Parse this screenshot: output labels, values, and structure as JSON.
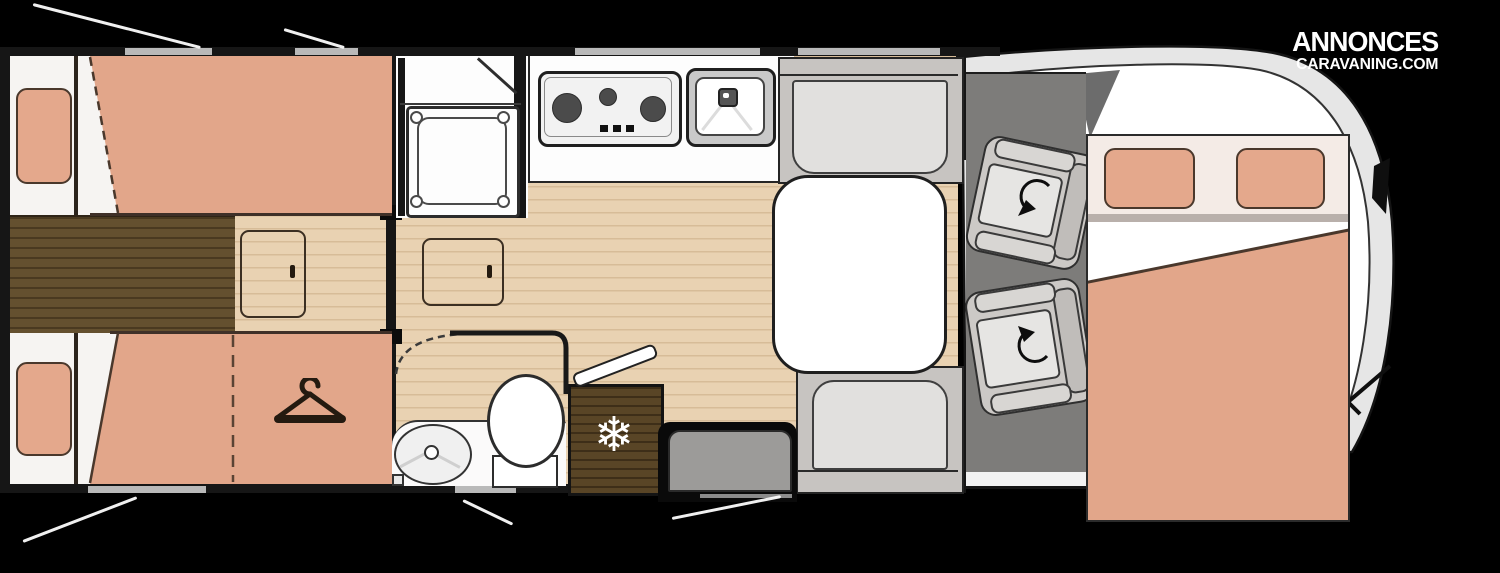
{
  "brand": {
    "line1": "ANNONCES",
    "line2": "CARAVANING.COM"
  },
  "icons": {
    "snowflake": "❄"
  },
  "palette": {
    "background": "#000000",
    "upholstery_salmon": "#e2a68a",
    "bed_linen_white": "#ffffff",
    "drop_bed_header": "#f4ebe6",
    "wood_floor_light": "#e9d2b2",
    "wood_dark": "#64502f",
    "fridge_wood": "#594526",
    "bench_gray": "#c7c4c1",
    "cab_floor_gray": "#7d7c7a",
    "wall_dark": "#161616",
    "vehicle_shell": "#e6e6e6"
  }
}
